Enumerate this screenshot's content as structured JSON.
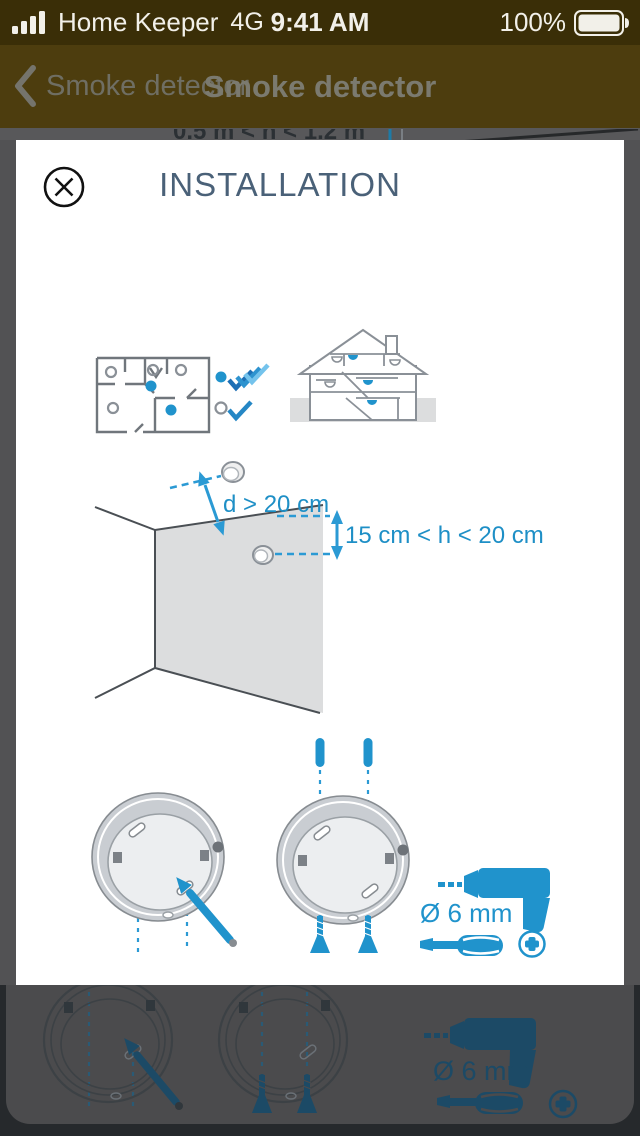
{
  "status_bar": {
    "carrier": "Home Keeper",
    "network": "4G",
    "time": "9:41 AM",
    "battery_percent": "100%"
  },
  "nav_bar": {
    "back_label": "Smoke detector",
    "title": "Smoke detector"
  },
  "background_page": {
    "clipped_heading": "0.5 m < h < 1.2 m",
    "drill_diameter_label": "Ø 6 mm"
  },
  "modal": {
    "title": "INSTALLATION",
    "wall_diagram": {
      "ceiling_distance_label": "d > 20 cm",
      "wall_height_label": "15 cm < h < 20 cm"
    },
    "tools": {
      "drill_diameter_label": "Ø 6 mm"
    }
  },
  "icons": {
    "status": [
      "cellular-signal-bars",
      "battery-full"
    ],
    "nav": "chevron-left",
    "modal_close": "circled-x",
    "diagrams": [
      "floor-plan-with-detectors",
      "house-cross-section",
      "ceiling-wall-corner",
      "detector-base",
      "pencil",
      "wall-plug",
      "screw",
      "drill",
      "screwdriver",
      "phillips-screw-head",
      "checkmarks"
    ]
  },
  "colors": {
    "accent_blue": "#2093cc",
    "heading_slate": "#4a6178",
    "status_bar_bg": "#3a2e07",
    "nav_bar_bg": "#4d3d0e",
    "dim_gray": "#525254",
    "dim_teal": "#1c4a66"
  }
}
